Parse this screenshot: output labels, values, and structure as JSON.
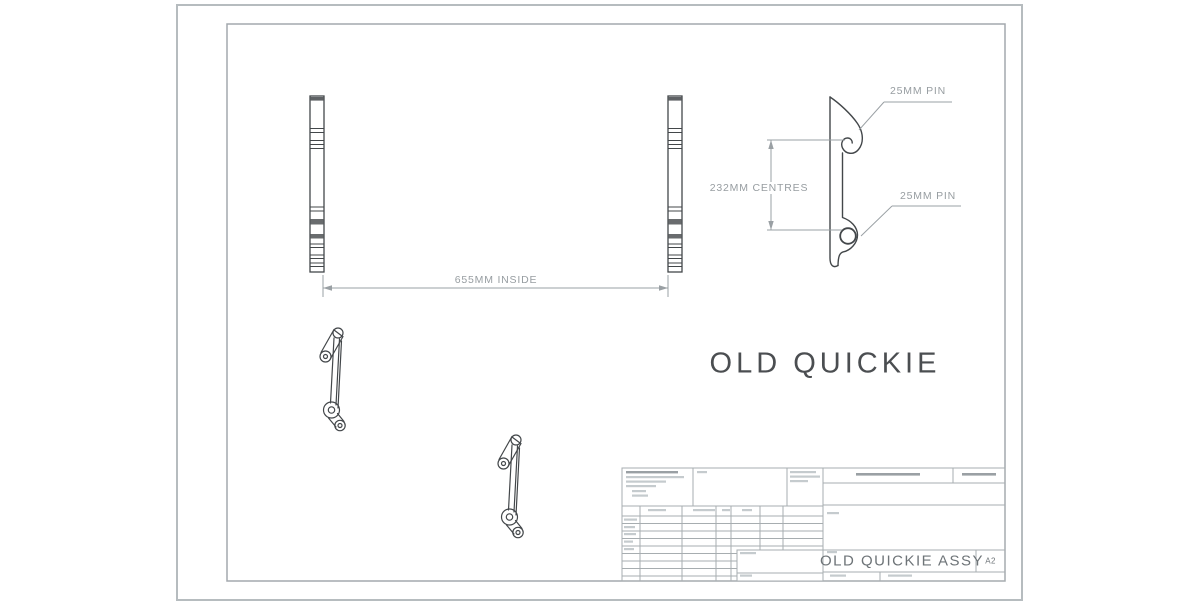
{
  "drawing": {
    "big_label": "OLD QUICKIE"
  },
  "dimensions": {
    "inside_width": "655MM INSIDE",
    "pin_centres": "232MM CENTRES",
    "pin_top": "25MM PIN",
    "pin_bottom": "25MM PIN"
  },
  "title_block": {
    "drawing_title": "OLD QUICKIE ASSY",
    "sheet_size": "A2"
  },
  "colors": {
    "part_line": "#43474a",
    "dimension_line": "#9aa0a4",
    "dimension_text": "#979da1",
    "big_label_text": "#4b4e51",
    "title_block_grid": "#a7adb0",
    "title_block_text": "#6e7478"
  }
}
